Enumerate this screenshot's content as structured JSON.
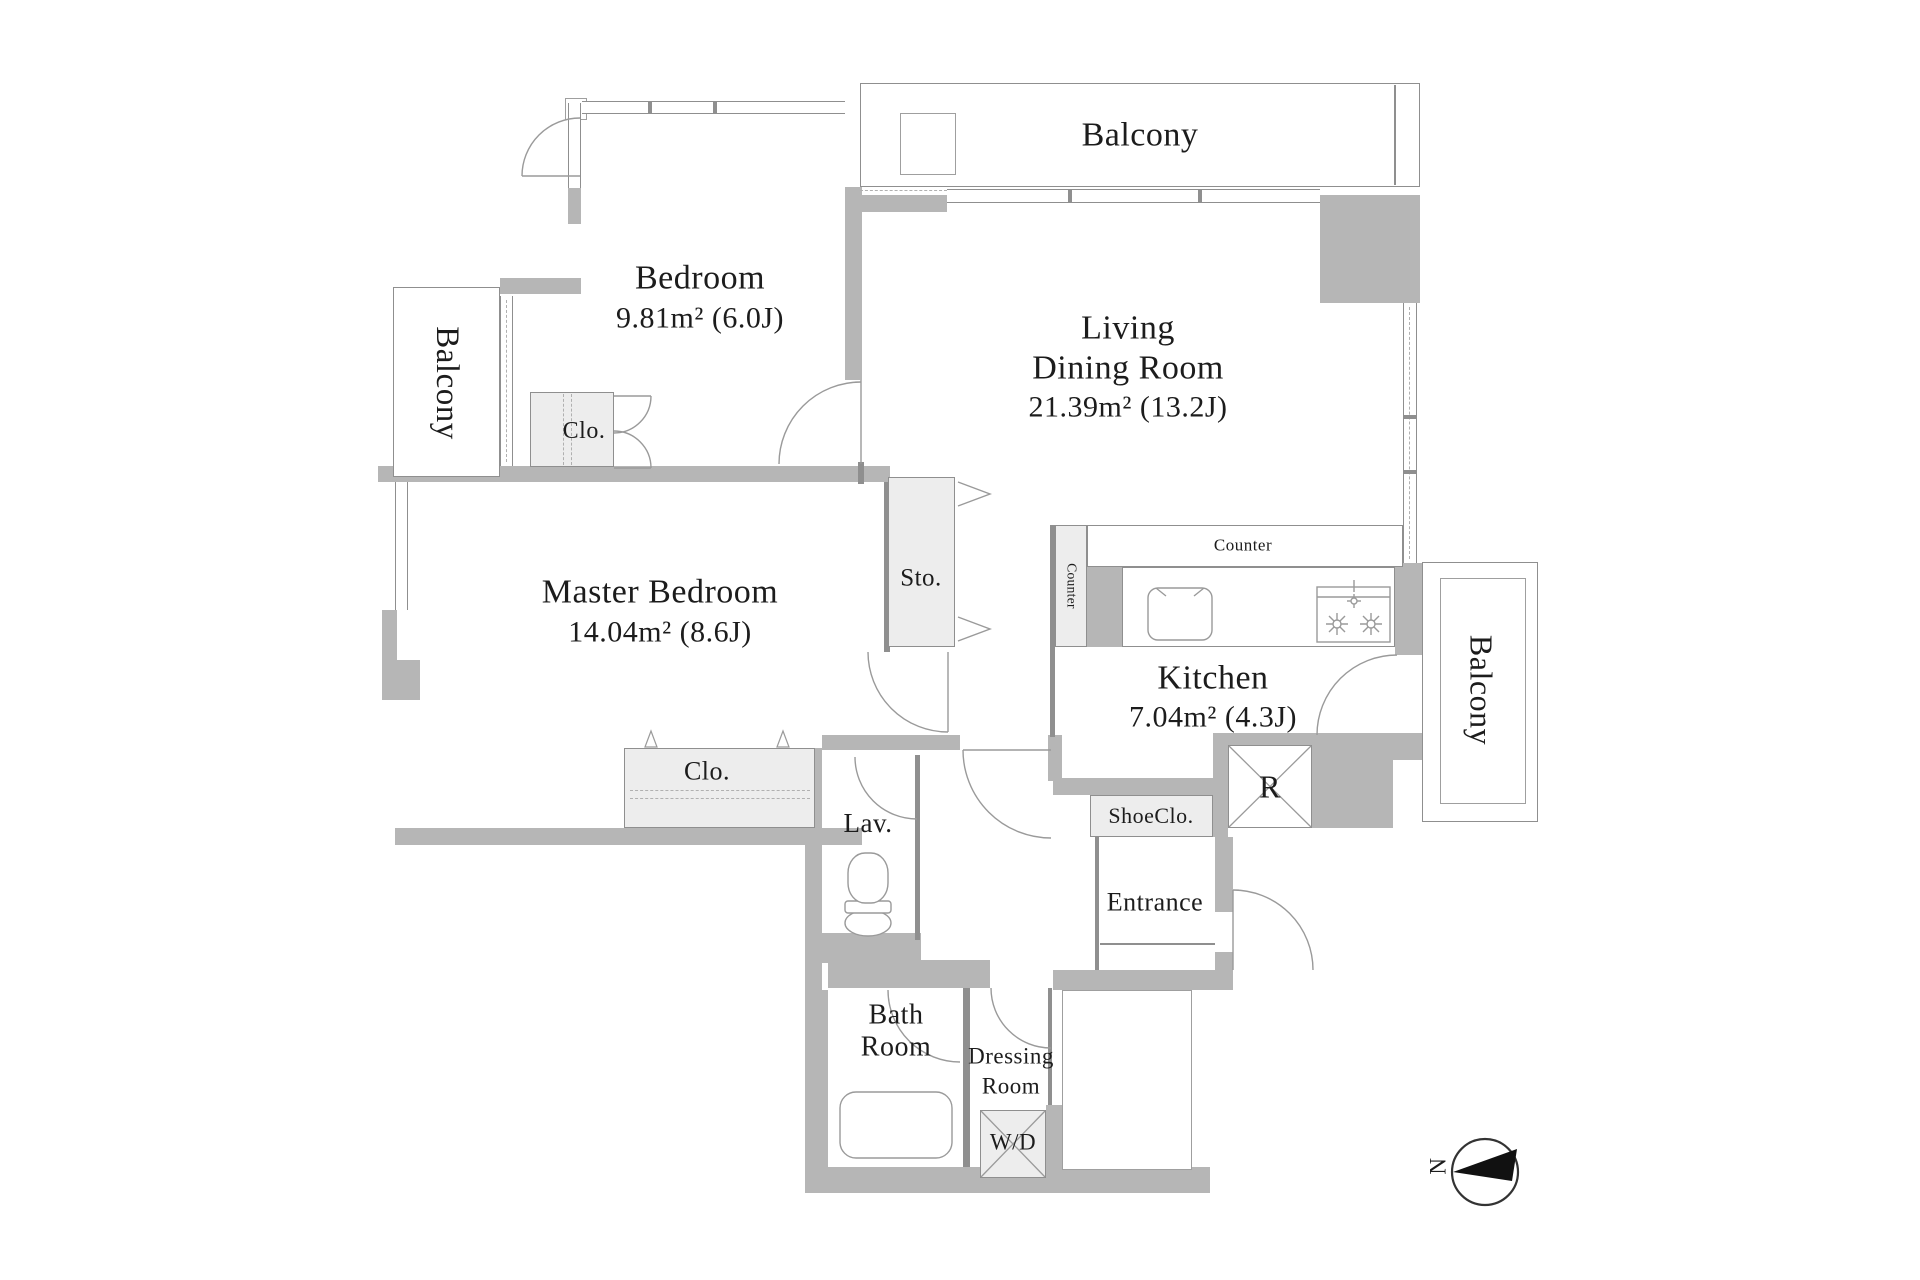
{
  "plan_type": "floor-plan",
  "colors": {
    "wall_fill": "#b6b6b6",
    "fixture_fill": "#ededed",
    "line": "#8f8f8f",
    "text": "#1c1c1c",
    "compass_fill": "#111111"
  },
  "balconies": {
    "top": "Balcony",
    "left": "Balcony",
    "right": "Balcony"
  },
  "rooms": {
    "bedroom": {
      "name": "Bedroom",
      "area": "9.81m² (6.0J)"
    },
    "living_dining": {
      "name_line1": "Living",
      "name_line2": "Dining Room",
      "area": "21.39m² (13.2J)"
    },
    "master_bedroom": {
      "name": "Master Bedroom",
      "area": "14.04m² (8.6J)"
    },
    "kitchen": {
      "name": "Kitchen",
      "area": "7.04m² (4.3J)"
    },
    "bath_room": {
      "name_line1": "Bath",
      "name_line2": "Room"
    },
    "dressing_room": {
      "name_line1": "Dressing",
      "name_line2": "Room"
    },
    "entrance": {
      "name": "Entrance"
    },
    "lavatory": {
      "name": "Lav."
    }
  },
  "closets": {
    "bedroom_closet": "Clo.",
    "master_closet": "Clo.",
    "storage": "Sto.",
    "shoe_closet": "ShoeClo."
  },
  "kitchen_labels": {
    "counter_side": "Counter",
    "counter_front": "Counter",
    "refrigerator": "R"
  },
  "laundry": {
    "washer_dryer": "W/D"
  },
  "compass": {
    "north": "N"
  }
}
